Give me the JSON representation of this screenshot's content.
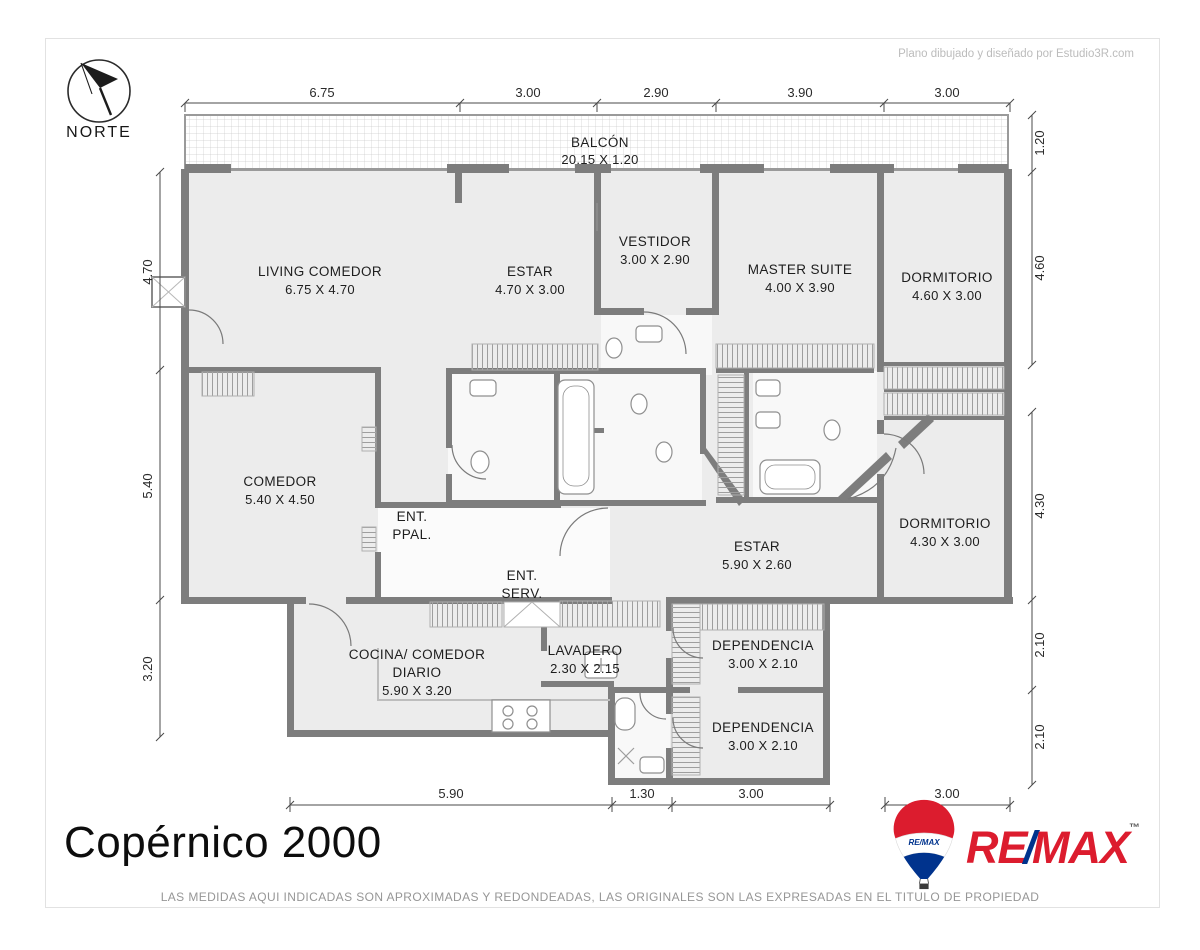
{
  "page": {
    "credit": "Plano dibujado y diseñado por Estudio3R.com",
    "title": "Copérnico 2000",
    "disclaimer": "LAS MEDIDAS AQUI INDICADAS SON APROXIMADAS Y REDONDEADAS, LAS ORIGINALES SON LAS EXPRESADAS EN EL TITULO DE PROPIEDAD",
    "north_label": "NORTE"
  },
  "plan": {
    "rooms": [
      {
        "line1": "BALCÓN",
        "dims": "20.15 X 1.20"
      },
      {
        "line1": "LIVING COMEDOR",
        "dims": "6.75 X 4.70"
      },
      {
        "line1": "ESTAR",
        "dims": "4.70 X 3.00"
      },
      {
        "line1": "VESTIDOR",
        "dims": "3.00 X 2.90"
      },
      {
        "line1": "MASTER SUITE",
        "dims": "4.00 X 3.90"
      },
      {
        "line1": "DORMITORIO",
        "dims": "4.60 X 3.00"
      },
      {
        "line1": "COMEDOR",
        "dims": "5.40 X 4.50"
      },
      {
        "line1": "ENT.",
        "line2": "PPAL."
      },
      {
        "line1": "ENT.",
        "line2": "SERV."
      },
      {
        "line1": "ESTAR",
        "dims": "5.90 X 2.60"
      },
      {
        "line1": "DORMITORIO",
        "dims": "4.30 X 3.00"
      },
      {
        "line1": "COCINA/ COMEDOR",
        "line2": "DIARIO",
        "dims": "5.90 X 3.20"
      },
      {
        "line1": "LAVADERO",
        "dims": "2.30 X 2.15"
      },
      {
        "line1": "DEPENDENCIA",
        "dims": "3.00 X 2.10"
      },
      {
        "line1": "DEPENDENCIA",
        "dims": "3.00 X 2.10"
      }
    ],
    "dims": {
      "top": [
        "6.75",
        "3.00",
        "2.90",
        "3.90",
        "3.00"
      ],
      "left": [
        "4.70",
        "5.40",
        "3.20"
      ],
      "right": [
        "1.20",
        "4.60",
        "4.30",
        "2.10",
        "2.10"
      ],
      "bottom": [
        "5.90",
        "1.30",
        "3.00",
        "3.00"
      ]
    }
  },
  "brand": {
    "balloon_text": "RE/MAX",
    "wordmark": {
      "re": "RE",
      "slash": "/",
      "max": "MAX",
      "tm": "™"
    },
    "colors": {
      "red": "#dc1c2e",
      "blue": "#00338d"
    }
  }
}
